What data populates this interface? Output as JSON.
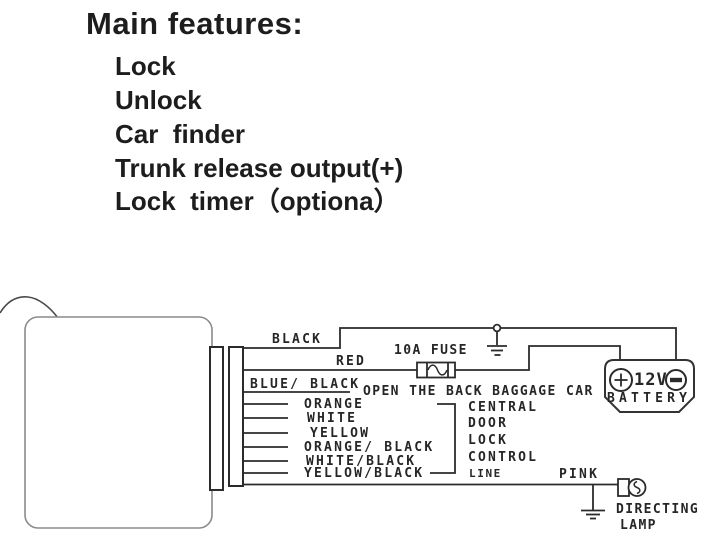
{
  "features": {
    "title": "Main features:",
    "items": [
      "Lock",
      "Unlock",
      "Car  finder",
      "Trunk release output(+)",
      "Lock  timer（optiona）"
    ]
  },
  "diagram": {
    "wire_labels": {
      "black": "BLACK",
      "red": "RED",
      "blue_black": "BLUE/ BLACK",
      "orange": "ORANGE",
      "white": "WHITE",
      "yellow": "YELLOW",
      "orange_black": "ORANGE/ BLACK",
      "white_black": "WHITE/BLACK",
      "yellow_black": "YELLOW/BLACK",
      "pink": "PINK"
    },
    "fuse_label": "10A FUSE",
    "open_back_label": "OPEN THE BACK BAGGAGE CAR",
    "central_door_lock": [
      "CENTRAL",
      "DOOR",
      "LOCK",
      "CONTROL",
      "LINE"
    ],
    "battery": {
      "voltage": "12V",
      "label": "BATTERY"
    },
    "lamp_caption": [
      "DIRECTING",
      "LAMP"
    ],
    "icons": {
      "battery_plus": "circle-plus",
      "battery_minus": "circle-minus",
      "ground": "earth-ground",
      "fuse": "fuse-element",
      "lamp": "bulb-with-filament"
    },
    "colors": {
      "line": "#2b2b2b",
      "module_outline": "#8b8b8b",
      "text": "#232323"
    }
  }
}
